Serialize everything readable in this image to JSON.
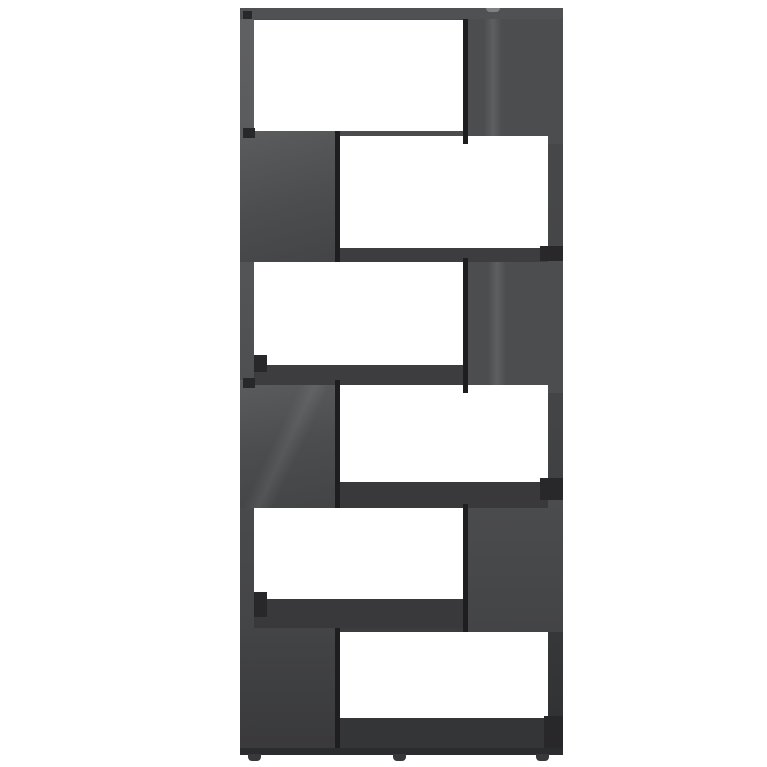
{
  "image": {
    "type": "product-photo",
    "subject": "Six-tier zig-zag book cabinet / room divider in high-gloss grey, front view on plain white background",
    "text_content": "none"
  },
  "colors": {
    "background": "#ffffff",
    "opening": "#ffffff",
    "panel": "#4c4d4f",
    "panel_light": "#5b5c5e",
    "panel_dark": "#434446",
    "base_top": "#4a4b4d",
    "base_bottom": "#38393b",
    "shelf": "#3d3d3f",
    "shelf_dark": "#39393b",
    "plinth": "#343537",
    "edge": "#1e1e20",
    "notch": "#28282a",
    "strip_left_top": "#606163",
    "strip_left_bottom": "#3f4042",
    "strip_right_top": "#48494b",
    "strip_right_bottom": "#2f3032",
    "top_board": "#505153",
    "top_highlight": "#a8a9ab",
    "bottom_edge": "#2b2c2e",
    "foot": "#38383a"
  },
  "structure": {
    "tier_count": 6,
    "tiers": [
      {
        "row": 1,
        "opening_side": "left",
        "solid_side": "right"
      },
      {
        "row": 2,
        "opening_side": "right",
        "solid_side": "left"
      },
      {
        "row": 3,
        "opening_side": "left",
        "solid_side": "right"
      },
      {
        "row": 4,
        "opening_side": "right",
        "solid_side": "left"
      },
      {
        "row": 5,
        "opening_side": "left",
        "solid_side": "right"
      },
      {
        "row": 6,
        "opening_side": "right",
        "solid_side": "left"
      }
    ],
    "feet_count": 3,
    "finish": "high gloss"
  }
}
